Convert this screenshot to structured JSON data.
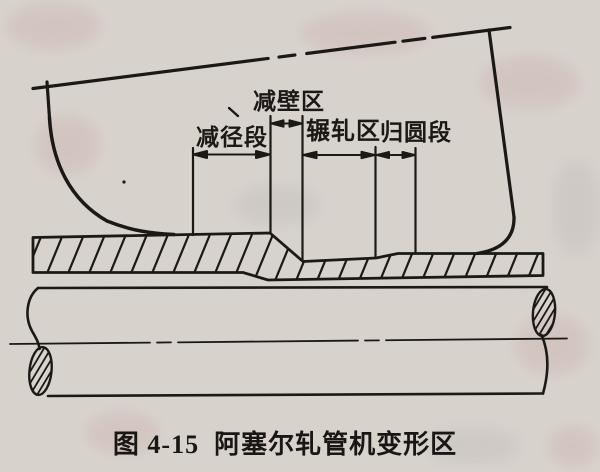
{
  "figure": {
    "caption": "图 4-15  阿塞尔轧管机变形区",
    "zone_labels": {
      "wall_reduction_zone": "减壁区",
      "diameter_reduction_section": "减径段",
      "rolling_zone": "辗轧区",
      "rounding_section": "归圆段"
    },
    "colors": {
      "paper": "#d8d2cd",
      "ink": "#1b1916"
    }
  }
}
